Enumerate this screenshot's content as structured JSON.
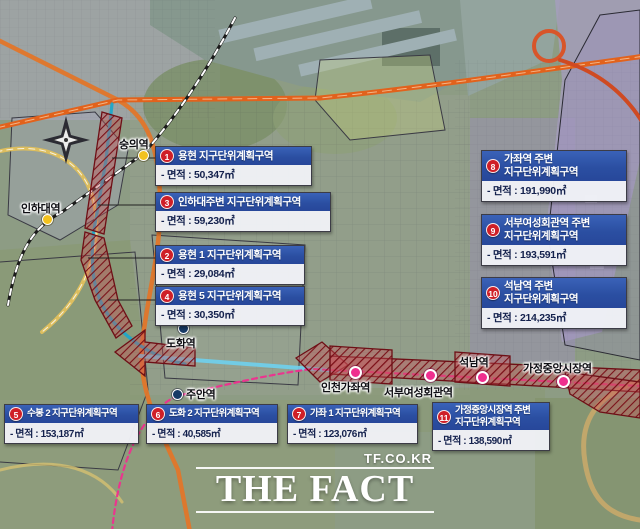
{
  "stations": [
    {
      "id": "sungui",
      "name": "숭의역"
    },
    {
      "id": "inha-univ",
      "name": "인하대역"
    },
    {
      "id": "dohwa",
      "name": "도화역"
    },
    {
      "id": "juan",
      "name": "주안역"
    },
    {
      "id": "incheon-gajwa",
      "name": "인천가좌역"
    },
    {
      "id": "seobu-womens-hall",
      "name": "서부여성회관역"
    },
    {
      "id": "seoknam",
      "name": "석남역"
    },
    {
      "id": "gajeong-central-market",
      "name": "가정중앙시장역"
    }
  ],
  "zones": [
    {
      "no": "1",
      "title": "용현 지구단위계획구역",
      "area": "- 면적 : 50,347㎡"
    },
    {
      "no": "2",
      "title": "용현 1 지구단위계획구역",
      "area": "- 면적 : 29,084㎡"
    },
    {
      "no": "3",
      "title": "인하대주변 지구단위계획구역",
      "area": "- 면적 : 59,230㎡"
    },
    {
      "no": "4",
      "title": "용현 5 지구단위계획구역",
      "area": "- 면적 : 30,350㎡"
    },
    {
      "no": "5",
      "title": "수봉 2 지구단위계획구역",
      "area": "- 면적 : 153,187㎡"
    },
    {
      "no": "6",
      "title": "도화 2 지구단위계획구역",
      "area": "- 면적 : 40,585㎡"
    },
    {
      "no": "7",
      "title": "가좌 1 지구단위계획구역",
      "area": "- 면적 : 123,076㎡"
    },
    {
      "no": "8",
      "title": "가좌역 주변\n지구단위계획구역",
      "area": "- 면적 : 191,990㎡"
    },
    {
      "no": "9",
      "title": "서부여성회관역 주변\n지구단위계획구역",
      "area": "- 면적 : 193,591㎡"
    },
    {
      "no": "10",
      "title": "석남역 주변\n지구단위계획구역",
      "area": "- 면적 : 214,235㎡"
    },
    {
      "no": "11",
      "title": "가정중앙시장역 주변\n지구단위계획구역",
      "area": "- 면적 : 138,590㎡"
    }
  ],
  "watermark": {
    "site": "TF.CO.KR",
    "logo": "THE FACT"
  },
  "colors": {
    "header_blue": "#2b4fa2",
    "badge_red": "#cf1f27",
    "zone_red": "#b03840",
    "line_teal": "#1fa6c9",
    "line_light_blue": "#6ed0ee",
    "line_pink": "#ef2f8f",
    "highway_orange": "#e2762a",
    "station_yellow": "#f2c21e",
    "station_navy": "#173a66"
  }
}
